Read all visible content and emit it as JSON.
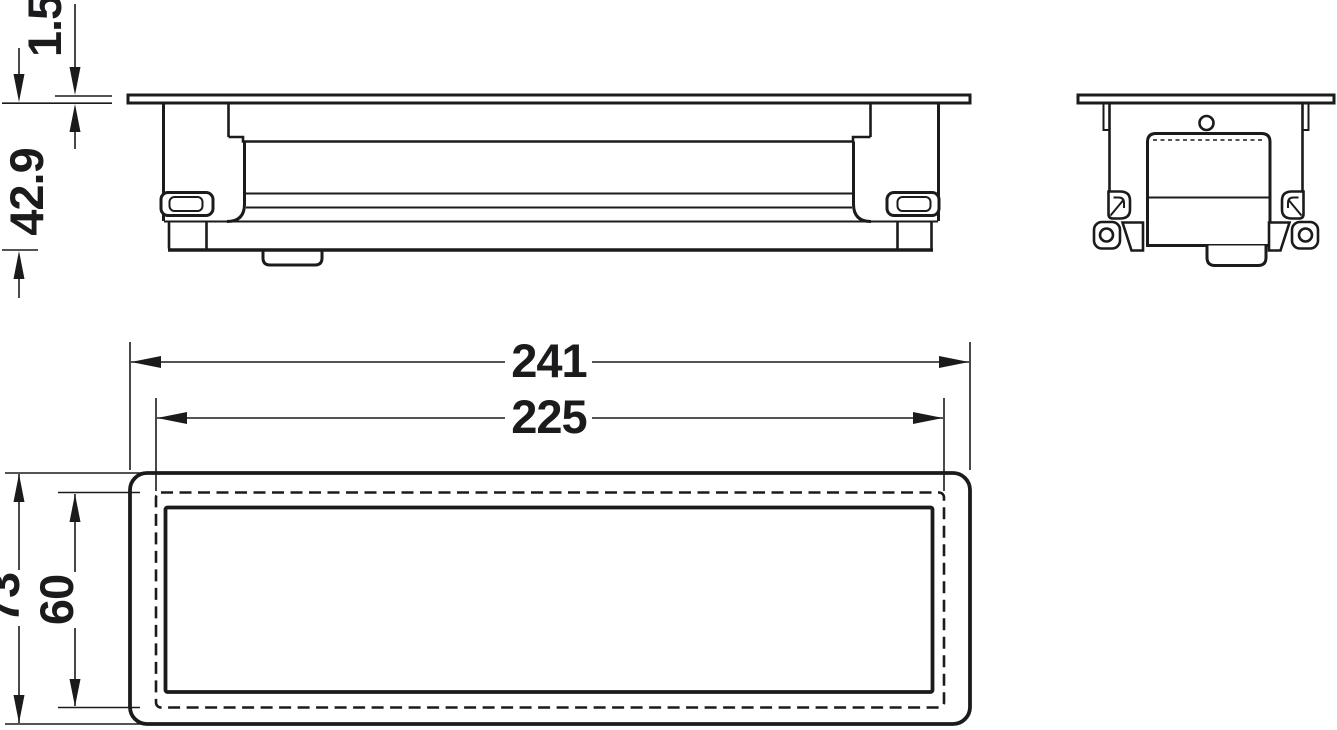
{
  "colors": {
    "ink": "#1b1b1d",
    "background": "#ffffff"
  },
  "dims": {
    "flange_thickness": "1.5",
    "installation_depth": "42.9",
    "overall_length": "241",
    "cutout_length": "225",
    "overall_width": "73",
    "cutout_width": "60"
  }
}
